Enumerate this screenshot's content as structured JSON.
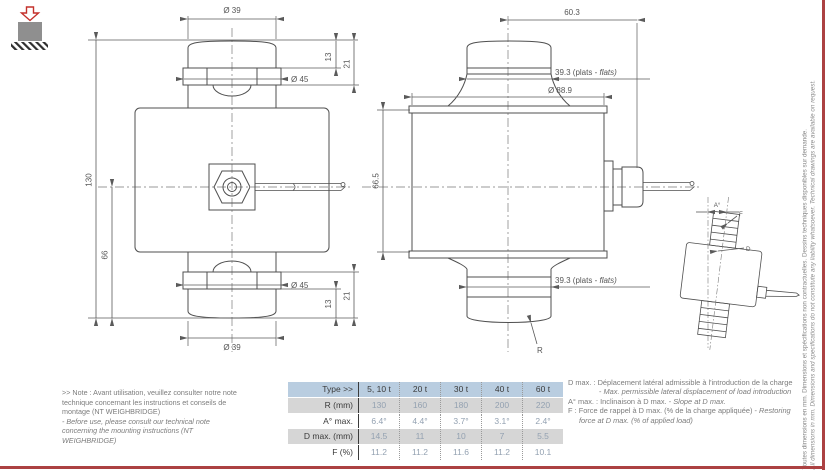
{
  "page": {
    "accent_red": "#ac4142"
  },
  "front_view": {
    "dia_top": "Ø 39",
    "dia_flange_top": "Ø 45",
    "h13_top": "13",
    "h21_top": "21",
    "h_total": "130",
    "h_center": "66",
    "dia_flange_bot": "Ø 45",
    "h13_bot": "13",
    "h21_bot": "21",
    "dia_bot": "Ø 39"
  },
  "side_view": {
    "offset": "60.3",
    "flats_a": "39.3 (plats - ",
    "flats_b": "flats)",
    "dia_body": "Ø 88.9",
    "h_body": "66.5",
    "flats2_a": "39.3 (plats - ",
    "flats2_b": "flats)",
    "radius": "R"
  },
  "tilt_view": {
    "angle": "A°",
    "force": "F",
    "displacement": "D"
  },
  "note_left": {
    "fr": ">> Note : Avant utilisation, veuillez consulter notre note technique concernant les instructions et conseils de montage (NT WEIGHBRIDGE)",
    "en": "- Before use, please consult our technical note concerning the mounting instructions (NT WEIGHBRIDGE)"
  },
  "table": {
    "header": [
      "Type >>",
      "5, 10 t",
      "20 t",
      "30 t",
      "40 t",
      "60 t"
    ],
    "rows": [
      {
        "label": "R (mm)",
        "values": [
          "130",
          "160",
          "180",
          "200",
          "220"
        ]
      },
      {
        "label": "A° max.",
        "values": [
          "6.4°",
          "4.4°",
          "3.7°",
          "3.1°",
          "2.4°"
        ]
      },
      {
        "label": "D max. (mm)",
        "values": [
          "14.5",
          "11",
          "10",
          "7",
          "5.5"
        ]
      },
      {
        "label": "F (%)",
        "values": [
          "11.2",
          "11.2",
          "11.6",
          "11.2",
          "10.1"
        ]
      }
    ],
    "header_bg": "#b9cde0",
    "alt_row_bg": "#d6d6d6",
    "value_color": "#93a1b1"
  },
  "notes_right": [
    {
      "term": "D max. :",
      "fr": "Déplacement latéral admissible à l'introduction de la charge - ",
      "en": "Max. permissible lateral displacement of load introduction"
    },
    {
      "term": "A° max. :",
      "fr": "Inclinaison à D max. - ",
      "en": "Slope at D max."
    },
    {
      "term": "F :",
      "fr": "Force de rappel à D max. (% de la charge appliquée) - ",
      "en": "Restoring force at D max. (% of applied load)"
    }
  ],
  "margin_note": {
    "fr": "Toutes dimensions en mm. Dimensions et spécifications non contractuelles. Dessins techniques disponibles sur demande.",
    "en": "All dimensions in mm. Dimensions and specifications do not constitute any liability whatsoever. Technical drawings are available on request."
  }
}
